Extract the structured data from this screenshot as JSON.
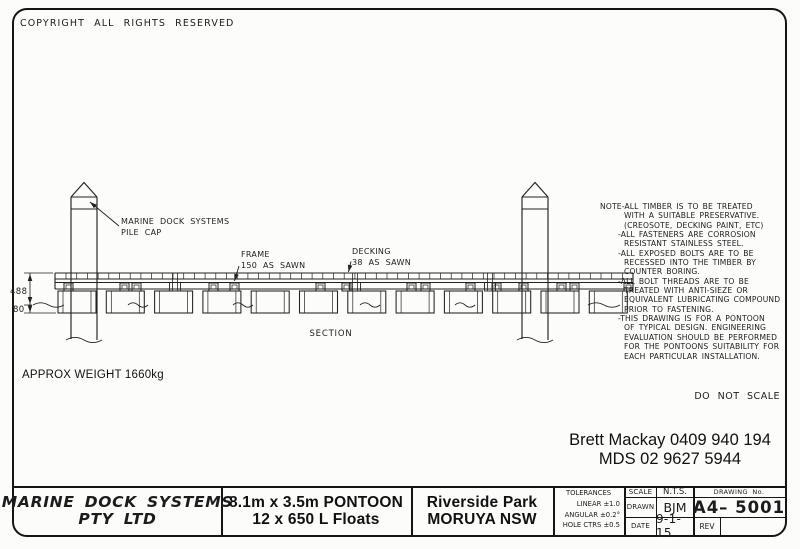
{
  "sheet": {
    "copyright": "COPYRIGHT ALL RIGHTS RESERVED",
    "do_not_scale": "DO NOT SCALE",
    "approx_weight": "APPROX WEIGHT 1660kg",
    "contact": {
      "line1": "Brett Mackay 0409 940 194",
      "line2": "MDS 02 9627 5944"
    }
  },
  "drawing": {
    "labels": {
      "pile_cap_line1": "MARINE DOCK SYSTEMS",
      "pile_cap_line2": "PILE CAP",
      "frame_line1": "FRAME",
      "frame_line2": "150 AS SAWN",
      "decking_line1": "DECKING",
      "decking_line2": "38 AS SAWN",
      "section": "SECTION",
      "dim_height": "488",
      "dim_draft": "80"
    },
    "floats_count": 12,
    "line_color": "#222222"
  },
  "notes": {
    "lines": [
      {
        "text": "NOTE-ALL TIMBER IS TO BE TREATED",
        "indent": 0
      },
      {
        "text": "WITH A SUITABLE PRESERVATIVE.",
        "indent": 2
      },
      {
        "text": "(CREOSOTE, DECKING PAINT, ETC)",
        "indent": 2
      },
      {
        "text": "-ALL FASTENERS ARE CORROSION",
        "indent": 1
      },
      {
        "text": "RESISTANT STAINLESS STEEL.",
        "indent": 2
      },
      {
        "text": "-ALL EXPOSED BOLTS ARE TO BE",
        "indent": 1
      },
      {
        "text": "RECESSED INTO THE TIMBER BY",
        "indent": 2
      },
      {
        "text": "COUNTER BORING.",
        "indent": 2
      },
      {
        "text": "-ALL BOLT THREADS ARE TO BE",
        "indent": 1
      },
      {
        "text": "TREATED WITH ANTI-SIEZE OR",
        "indent": 2
      },
      {
        "text": "EQUIVALENT LUBRICATING COMPOUND",
        "indent": 2
      },
      {
        "text": "PRIOR TO FASTENING.",
        "indent": 2
      },
      {
        "text": "-THIS DRAWING IS FOR A PONTOON",
        "indent": 1
      },
      {
        "text": "OF TYPICAL DESIGN. ENGINEERING",
        "indent": 2
      },
      {
        "text": "EVALUATION SHOULD BE PERFORMED",
        "indent": 2
      },
      {
        "text": "FOR THE PONTOONS SUITABILITY FOR",
        "indent": 2
      },
      {
        "text": "EACH PARTICULAR INSTALLATION.",
        "indent": 2
      }
    ]
  },
  "title_block": {
    "company_line1": "MARINE DOCK SYSTEMS",
    "company_line2": "PTY LTD",
    "product_line1": "8.1m x 3.5m PONTOON",
    "product_line2": "12 x 650 L Floats",
    "project_line1": "Riverside Park",
    "project_line2": "MORUYA NSW",
    "tolerances": {
      "header": "TOLERANCES",
      "linear": "LINEAR ±1.0",
      "angular": "ANGULAR ±0.2°",
      "hole_ctrs": "HOLE CTRS ±0.5"
    },
    "scale_label": "SCALE",
    "scale_value": "N.T.S.",
    "drawn_label": "DRAWN",
    "drawn_value": "BJM",
    "date_label": "DATE",
    "date_value": "9-1-15",
    "drawing_no_label": "DRAWING No.",
    "drawing_no_value": "A4– 5001",
    "rev_label": "REV"
  }
}
